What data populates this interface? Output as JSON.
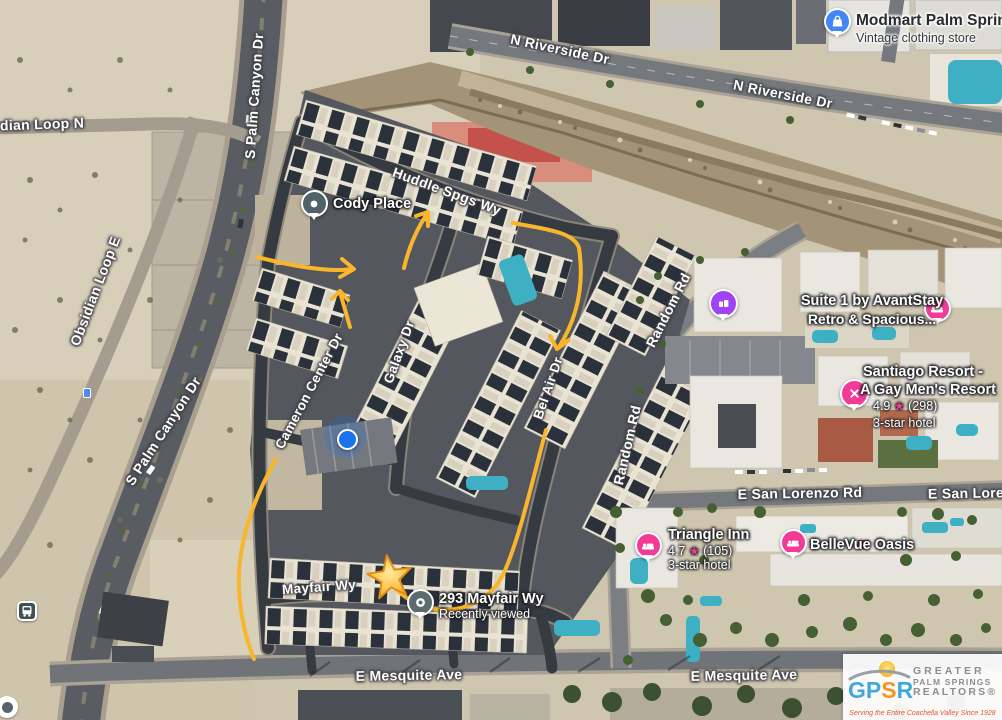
{
  "streets": {
    "n_riverside_1": "N Riverside Dr",
    "n_riverside_2": "N Riverside Dr",
    "obsidian_loop_n": "dian Loop N",
    "obsidian_loop_e": "Obsidian Loop E",
    "s_palm_canyon_top": "S Palm Canyon Dr",
    "s_palm_canyon_mid": "S Palm Canyon Dr",
    "huddle_spgs": "Huddle Spgs Wy",
    "cameron_center": "Cameron Center Dr",
    "galaxy": "Galaxy Dr",
    "bel_air": "Bel Air Dr",
    "random_1": "Random Rd",
    "random_2": "Random Rd",
    "san_lorenzo": "E San Lorenzo Rd",
    "san_lorenzo_clipped": "E San Lore",
    "mayfair": "Mayfair Wy",
    "mesquite_1": "E Mesquite Ave",
    "mesquite_2": "E Mesquite Ave"
  },
  "pois": {
    "modmart": {
      "name": "Modmart Palm Springs",
      "category": "Vintage clothing store"
    },
    "cody_place": {
      "name": "Cody Place"
    },
    "suite1": {
      "name": "Suite 1 by AvantStay",
      "subtitle": "Retro & Spacious..."
    },
    "santiago": {
      "name_line1": "Santiago Resort -",
      "name_line2": "A Gay Men's Resort",
      "rating": "4.9",
      "reviews": "(298)",
      "category": "3-star hotel"
    },
    "triangle_inn": {
      "name": "Triangle Inn",
      "rating": "4.7",
      "reviews": "(105)",
      "category": "3-star hotel"
    },
    "bellevue": {
      "name": "BelleVue Oasis"
    },
    "mayfair_293": {
      "name": "293 Mayfair Wy",
      "note": "Recently viewed"
    }
  },
  "icons": {
    "star": "★"
  },
  "watermark": {
    "acronym_g": "G",
    "acronym_p": "P",
    "acronym_s": "S",
    "acronym_r": "R",
    "line1": "GREATER",
    "line2": "PALM SPRINGS",
    "line3": "REALTORS®",
    "tagline": "Serving the Entire Coachella Valley Since 1928"
  },
  "colors": {
    "annotation": "#f9b52b",
    "hotel_pin": "#f23b97",
    "shopping_pin": "#4285f4",
    "attraction_pin": "#a142f4",
    "generic_pin": "#4f6369",
    "location_dot": "#1a73e8"
  }
}
